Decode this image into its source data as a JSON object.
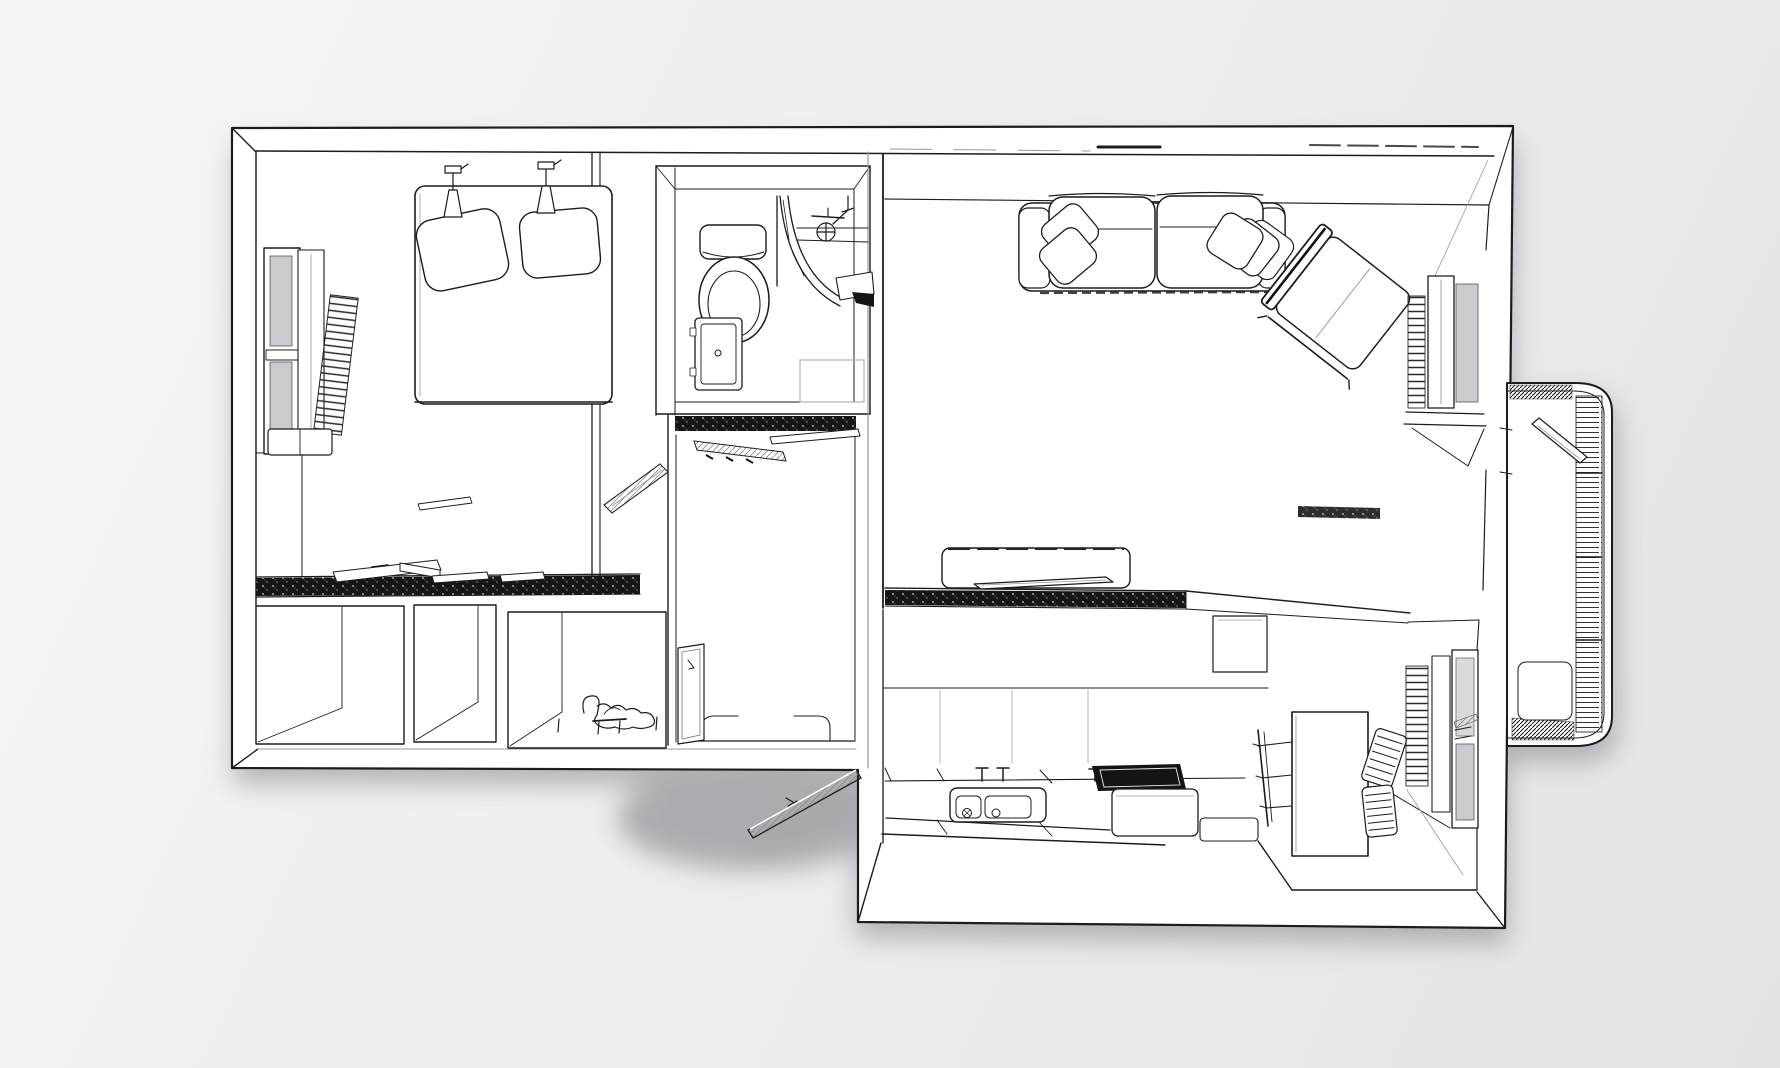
{
  "scene": {
    "title": "apartment-floor-plan-3d-render",
    "style": "monochrome architectural line-art, top-down 3d view, no text labels",
    "background_top": "#f5f5f7",
    "background_bottom": "#e3e3e6",
    "floor": "#ffffff",
    "ink": "#1c1c1c",
    "ink_soft": "#9a9a9e",
    "glass": "#c9cbce",
    "glass_light": "#d9dadc",
    "wall_fill": "#141414",
    "shadow": "#74767b"
  },
  "rooms": [
    {
      "name": "bedroom",
      "furniture": [
        "double-bed",
        "two-pillows",
        "two-wall-lamps",
        "window-with-blinds",
        "radiator",
        "nightstand",
        "sliding-wardrobe-panels",
        "wall-shelf"
      ]
    },
    {
      "name": "bathroom",
      "furniture": [
        "toilet",
        "curved-shower-screen",
        "shower-mixer",
        "washbasin-counter",
        "door-leaf",
        "bath-mat",
        "shower-bench"
      ]
    },
    {
      "name": "entry-hall",
      "furniture": [
        "coat-rack-planks",
        "wall-mirror",
        "floor-thresholds",
        "open-entry-door"
      ]
    },
    {
      "name": "living-room",
      "furniture": [
        "two-seat-sofa",
        "five-throw-pillows",
        "lounge-chair",
        "tv-sideboard",
        "window-radiator",
        "window"
      ]
    },
    {
      "name": "kitchen-dining",
      "furniture": [
        "kitchen-counter",
        "double-sink",
        "two-faucets",
        "cooktop",
        "base-cabinets",
        "dining-table",
        "three-dining-chairs",
        "radiator",
        "window"
      ]
    },
    {
      "name": "storage-closets",
      "furniture": [
        "closet-box-1",
        "closet-box-2",
        "closet-box-3",
        "reclining-figure",
        "small-bench"
      ]
    },
    {
      "name": "balcony",
      "furniture": [
        "ribbed-railing",
        "open-balcony-door",
        "floor-panel"
      ]
    }
  ]
}
